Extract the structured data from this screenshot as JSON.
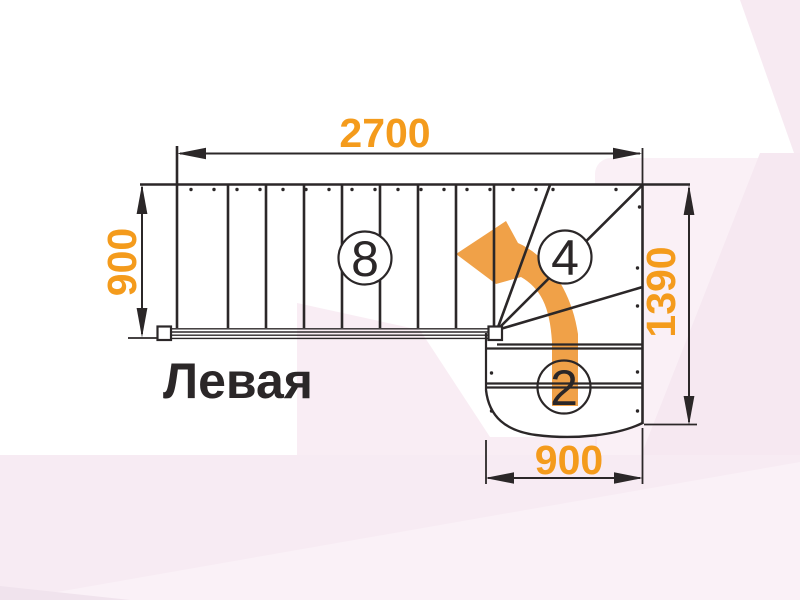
{
  "drawing": {
    "title": "Левая",
    "dimensions": {
      "top_width": "2700",
      "left_depth": "900",
      "right_depth": "1390",
      "bottom_width": "900"
    },
    "step_counts": {
      "straight_flight": "8",
      "winder_steps": "4",
      "bottom_flight": "2"
    },
    "colors": {
      "dimension_orange": "#f49b1c",
      "arrow_orange": "#f0a148",
      "line_ink": "#2b2728",
      "background_pink": "#faf0f6"
    }
  }
}
